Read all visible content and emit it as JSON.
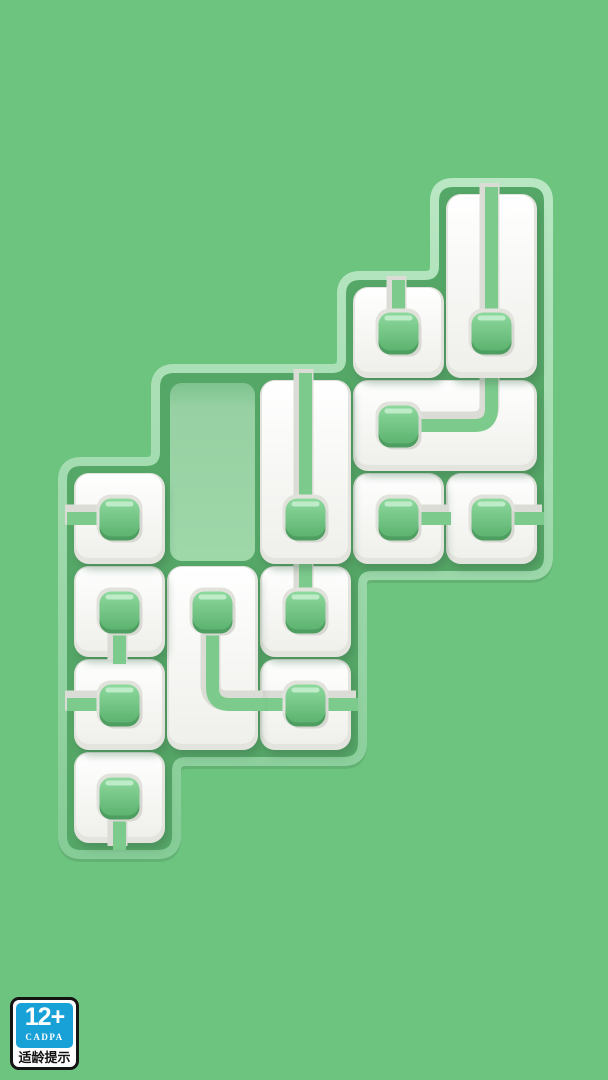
{
  "style": {
    "background": "#6cc47e",
    "board": {
      "rim_light": "#b9e7c3",
      "rim": "#86cc97",
      "rim_under": "#63b274",
      "floor": "#55a767",
      "slot_shadow": "#7fc28f",
      "slot_mid": "#97d1a3",
      "slot": "#9ed8a9"
    },
    "tile": {
      "seam": "#e4e4df",
      "top": "#ffffff",
      "bottom": "#efefeb",
      "shadow": "#3c6a4b"
    },
    "pipe": {
      "groove": "#dcdcd6",
      "green": "#7ccb8d"
    },
    "node": {
      "halo": "#e2e2dc",
      "soft_shadow": "#d8d8d2",
      "dark": "#4d9e60",
      "top": "#8ed99e",
      "bottom": "#5db370",
      "highlight": "#c4edcd"
    }
  },
  "board": {
    "origin_x": 73,
    "origin_y": 193,
    "cell_size": 93,
    "cols": 5,
    "rows": 7,
    "outline": [
      [
        445,
        193
      ],
      [
        538,
        193
      ],
      [
        538,
        565
      ],
      [
        352,
        565
      ],
      [
        352,
        751
      ],
      [
        166,
        751
      ],
      [
        166,
        844
      ],
      [
        73,
        844
      ],
      [
        73,
        472
      ],
      [
        166,
        472
      ],
      [
        166,
        379
      ],
      [
        352,
        379
      ],
      [
        352,
        286
      ],
      [
        445,
        286
      ]
    ],
    "empty_slot": {
      "col": 1,
      "row": 2,
      "w": 1,
      "h": 2
    }
  },
  "tiles": [
    {
      "id": "tile-c0r6",
      "col": 0,
      "row": 6,
      "w": 1,
      "h": 1,
      "node": [
        0.5,
        0.5
      ],
      "pipe": [
        [
          0.5,
          0.5
        ],
        [
          0.5,
          1
        ]
      ]
    },
    {
      "id": "tile-c2r5",
      "col": 2,
      "row": 5,
      "w": 1,
      "h": 1,
      "node": [
        0.5,
        0.5
      ],
      "pipe": [
        [
          0,
          0.5
        ],
        [
          1,
          0.5
        ]
      ]
    },
    {
      "id": "tile-c0r5",
      "col": 0,
      "row": 5,
      "w": 1,
      "h": 1,
      "node": [
        0.5,
        0.5
      ],
      "pipe": [
        [
          0,
          0.5
        ],
        [
          0.5,
          0.5
        ]
      ]
    },
    {
      "id": "tile-c2r4",
      "col": 2,
      "row": 4,
      "w": 1,
      "h": 1,
      "node": [
        0.5,
        0.5
      ],
      "pipe": [
        [
          0.5,
          0
        ],
        [
          0.5,
          0.5
        ]
      ]
    },
    {
      "id": "tile-c1r4",
      "col": 1,
      "row": 4,
      "w": 1,
      "h": 2,
      "node": [
        0.5,
        0.5
      ],
      "pipe": [
        [
          0.5,
          0.5
        ],
        [
          0.5,
          1.5
        ],
        [
          1,
          1.5
        ]
      ]
    },
    {
      "id": "tile-c0r4",
      "col": 0,
      "row": 4,
      "w": 1,
      "h": 1,
      "node": [
        0.5,
        0.5
      ],
      "pipe": [
        [
          0.5,
          0.5
        ],
        [
          0.5,
          1
        ]
      ]
    },
    {
      "id": "tile-c4r3",
      "col": 4,
      "row": 3,
      "w": 1,
      "h": 1,
      "node": [
        0.5,
        0.5
      ],
      "pipe": [
        [
          0.5,
          0.5
        ],
        [
          1,
          0.5
        ]
      ]
    },
    {
      "id": "tile-c3r3",
      "col": 3,
      "row": 3,
      "w": 1,
      "h": 1,
      "node": [
        0.5,
        0.5
      ],
      "pipe": [
        [
          0.5,
          0.5
        ],
        [
          1,
          0.5
        ]
      ]
    },
    {
      "id": "tile-c0r3",
      "col": 0,
      "row": 3,
      "w": 1,
      "h": 1,
      "node": [
        0.5,
        0.5
      ],
      "pipe": [
        [
          0,
          0.5
        ],
        [
          0.5,
          0.5
        ]
      ]
    },
    {
      "id": "tile-c3r2",
      "col": 3,
      "row": 2,
      "w": 2,
      "h": 1,
      "node": [
        0.5,
        0.5
      ],
      "pipe": [
        [
          0.5,
          0.5
        ],
        [
          1.5,
          0.5
        ],
        [
          1.5,
          0
        ]
      ]
    },
    {
      "id": "tile-c2r2",
      "col": 2,
      "row": 2,
      "w": 1,
      "h": 2,
      "node": [
        0.5,
        1.5
      ],
      "pipe": [
        [
          0.5,
          0
        ],
        [
          0.5,
          1.5
        ]
      ]
    },
    {
      "id": "tile-c3r1",
      "col": 3,
      "row": 1,
      "w": 1,
      "h": 1,
      "node": [
        0.5,
        0.5
      ],
      "pipe": [
        [
          0.5,
          0
        ],
        [
          0.5,
          0.5
        ]
      ]
    },
    {
      "id": "tile-c4r0",
      "col": 4,
      "row": 0,
      "w": 1,
      "h": 2,
      "node": [
        0.5,
        1.5
      ],
      "pipe": [
        [
          0.5,
          0
        ],
        [
          0.5,
          1.5
        ]
      ]
    }
  ],
  "age_badge": {
    "rating": "12+",
    "org": "CADPA",
    "caption": "适龄提示",
    "colors": {
      "bg": "#ffffff",
      "border": "#141414",
      "panel": "#17a1d6",
      "panel_text": "#ffffff",
      "caption_text": "#111111"
    }
  }
}
